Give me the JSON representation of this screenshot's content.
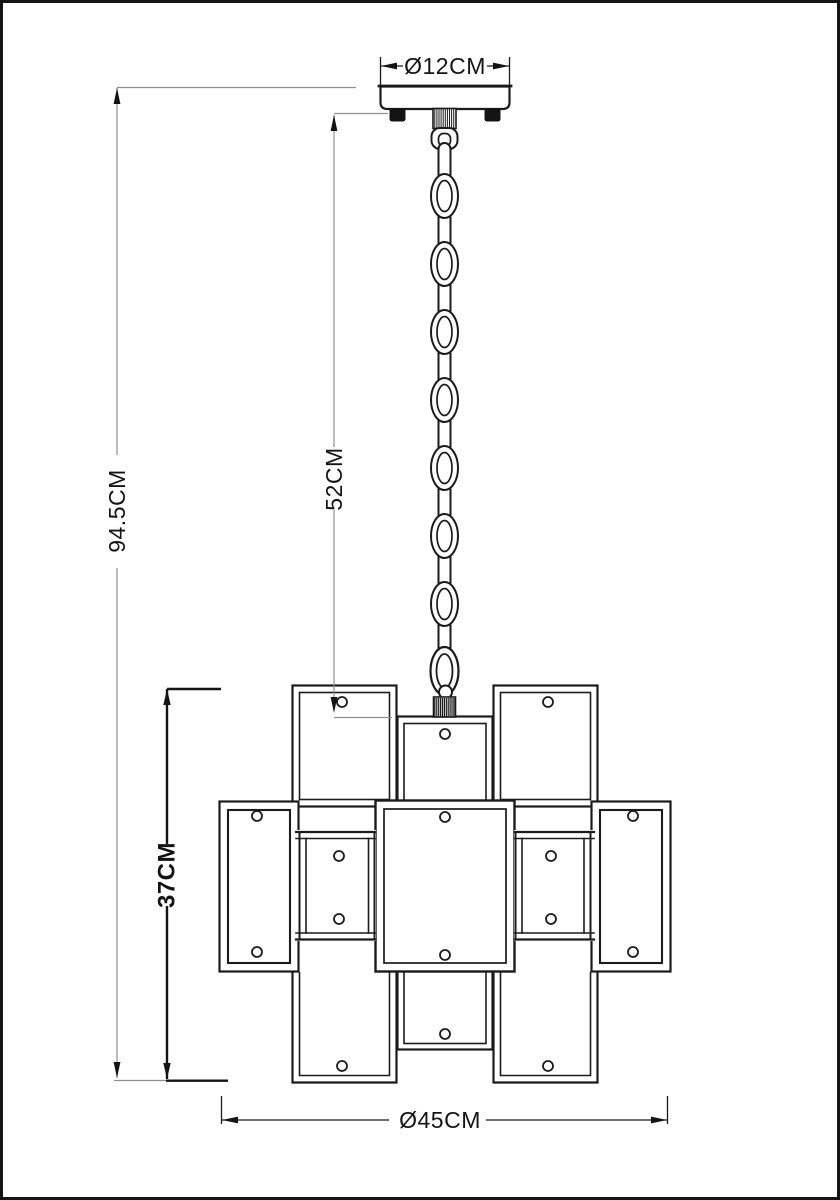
{
  "page": {
    "background": "#ffffff",
    "border_color": "#141414"
  },
  "diagram": {
    "subject": "Pendant chandelier technical dimension drawing",
    "labels": {
      "canopy_diameter": "Ø12CM",
      "overall_height": "94.5CM",
      "chain_drop": "52CM",
      "body_height": "37CM",
      "body_diameter": "Ø45CM"
    },
    "colors": {
      "line": "#1b1b1b",
      "dim_thin": "#8f8f8f",
      "dim_bold": "#141414"
    }
  }
}
